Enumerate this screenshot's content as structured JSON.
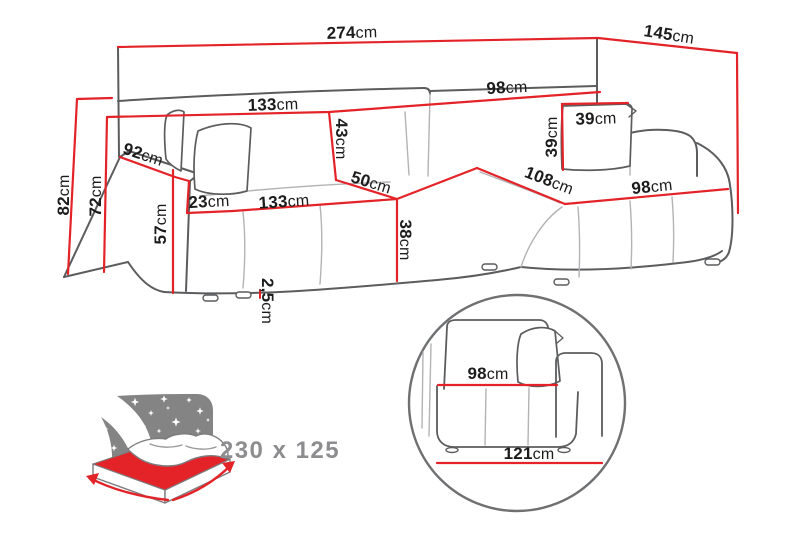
{
  "colors": {
    "dimension_red": "#e32328",
    "outline_gray": "#5b5c5e",
    "seam_gray": "#b3b3b5",
    "label_black": "#1c1c1c",
    "muted_gray": "#8d8d8f",
    "panel_gray": "#848484",
    "background": "#ffffff"
  },
  "dims": {
    "total_width": {
      "num": "274",
      "unit": "cm"
    },
    "total_depth": {
      "num": "145",
      "unit": "cm"
    },
    "back_width_left": {
      "num": "133",
      "unit": "cm"
    },
    "back_width_right": {
      "num": "98",
      "unit": "cm"
    },
    "backrest_height": {
      "num": "43",
      "unit": "cm"
    },
    "pillow_height": {
      "num": "39",
      "unit": "cm"
    },
    "pillow_width": {
      "num": "39",
      "unit": "cm"
    },
    "arm_depth": {
      "num": "92",
      "unit": "cm"
    },
    "height_total": {
      "num": "82",
      "unit": "cm"
    },
    "height_backrest": {
      "num": "72",
      "unit": "cm"
    },
    "arm_height": {
      "num": "57",
      "unit": "cm"
    },
    "arm_width": {
      "num": "23",
      "unit": "cm"
    },
    "seat_width_left": {
      "num": "133",
      "unit": "cm"
    },
    "seat_depth": {
      "num": "50",
      "unit": "cm"
    },
    "seat_height": {
      "num": "38",
      "unit": "cm"
    },
    "chaise_length": {
      "num": "108",
      "unit": "cm"
    },
    "chaise_width": {
      "num": "98",
      "unit": "cm"
    },
    "leg_height": {
      "num": "2,5",
      "unit": "cm"
    },
    "detail_seat_width": {
      "num": "98",
      "unit": "cm"
    },
    "detail_total_width": {
      "num": "121",
      "unit": "cm"
    }
  },
  "sleeping_area": {
    "size_label": "230 x 125"
  }
}
